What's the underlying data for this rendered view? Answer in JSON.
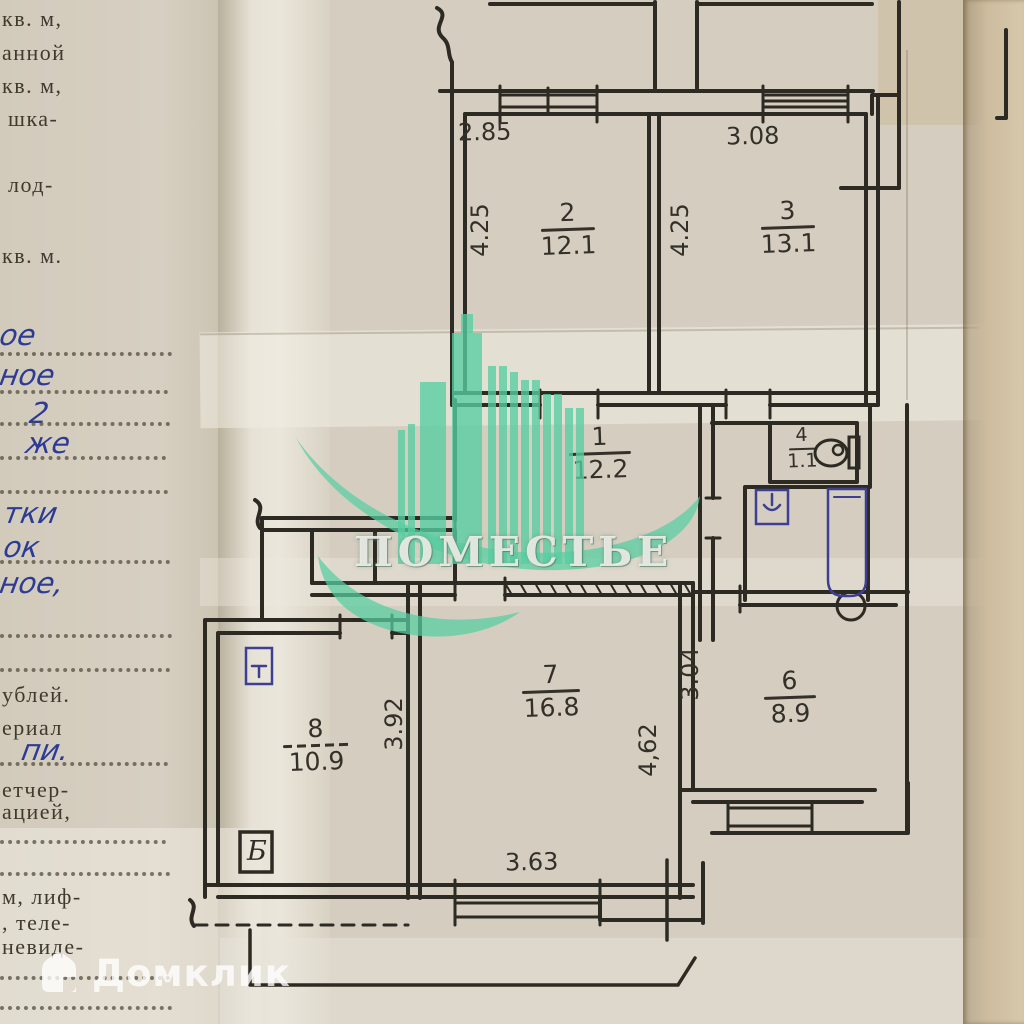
{
  "meta": {
    "description": "Фото листа техпаспорта с рукописным планом квартиры"
  },
  "left_page": {
    "typed": [
      "кв. м,",
      "анной",
      "кв. м,",
      "шка-",
      "лод-",
      "кв. м.",
      "ублей.",
      "ериал",
      "етчер-",
      "ацией,",
      "м, лиф-",
      ", теле-",
      "невиде-"
    ],
    "written": [
      "ое",
      "ное",
      "2",
      "же",
      "тки",
      "ок",
      "ное,",
      "пи."
    ]
  },
  "watermarks": {
    "brand": {
      "text": "ПОМЕСТЬЕ",
      "color": "#57cfa2"
    },
    "domclick": {
      "text": "Домклик"
    }
  },
  "plan": {
    "rooms": [
      {
        "number": "1",
        "area": "12.2"
      },
      {
        "number": "2",
        "area": "12.1"
      },
      {
        "number": "3",
        "area": "13.1"
      },
      {
        "number": "4",
        "area": "1.1"
      },
      {
        "number": "6",
        "area": "8.9"
      },
      {
        "number": "7",
        "area": "16.8"
      },
      {
        "number": "8",
        "area": "10.9"
      }
    ],
    "dims": {
      "top_left": "2.85",
      "top_right": "3.08",
      "room2_side": "4.25",
      "room3_side": "4.25",
      "kitchen_side": "3.04",
      "room7_side": "4,62",
      "room8_side": "3.92",
      "bottom": "3.63"
    },
    "symbols": {
      "balcony_door": "Б"
    },
    "ink": "#2c2a23",
    "fixture_ink": "#3c3f92"
  }
}
